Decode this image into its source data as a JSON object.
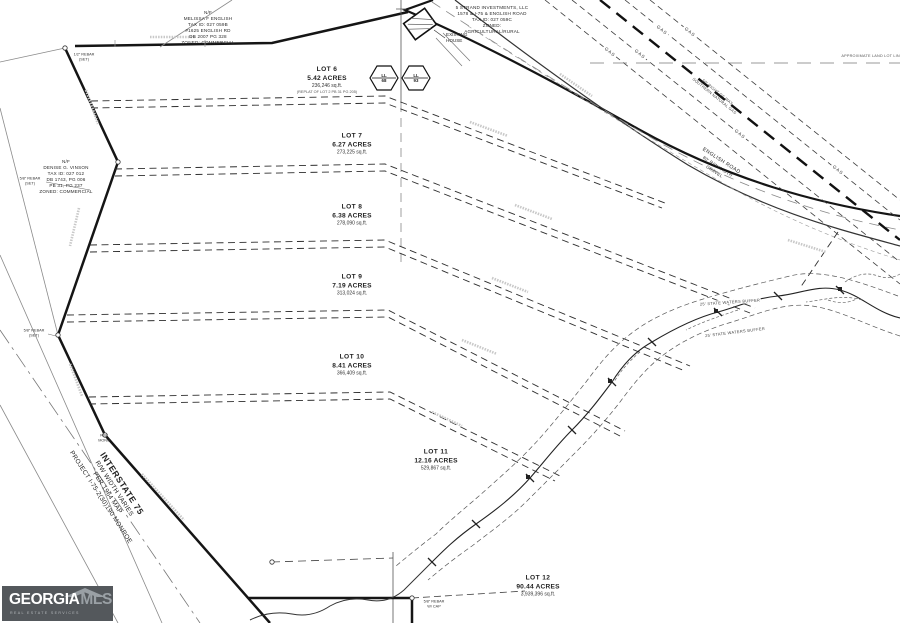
{
  "colors": {
    "line": "#151515",
    "gray": "#8a8a8a",
    "logo_bg": "#54585c"
  },
  "parcels": {
    "melissa": {
      "lines": [
        "N/F",
        "MELISSA F ENGLISH",
        "TAX ID: 027 059B",
        "#1625 ENGLISH RD",
        "DB 2007 PG 328",
        "ZONED: COMMERCIAL"
      ]
    },
    "strand": {
      "lines": [
        "5 STRAND INVESTMENTS, LLC",
        "1578 & I-75 & ENGLISH ROAD",
        "TAX ID: 027 059C",
        "ZONED:",
        "AGRICULTURAL/RURAL"
      ]
    },
    "vinson": {
      "lines": [
        "N/F",
        "DENISE G. VINSON",
        "TAX ID: 027 012",
        "DB 1743, PG 006",
        "PB 31, PG 237",
        "ZONED: COMMERCIAL"
      ]
    }
  },
  "lots": [
    {
      "name": "LOT 6",
      "acres": "5.42 ACRES",
      "sqft": "236,246 sq.ft.",
      "note": "(REPLAT OF LOT 2 PB 31 PG 205)"
    },
    {
      "name": "LOT 7",
      "acres": "6.27 ACRES",
      "sqft": "273,225 sq.ft."
    },
    {
      "name": "LOT 8",
      "acres": "6.38 ACRES",
      "sqft": "278,090 sq.ft."
    },
    {
      "name": "LOT 9",
      "acres": "7.19 ACRES",
      "sqft": "313,024 sq.ft."
    },
    {
      "name": "LOT 10",
      "acres": "8.41 ACRES",
      "sqft": "366,409 sq.ft."
    },
    {
      "name": "LOT 11",
      "acres": "12.16 ACRES",
      "sqft": "529,867 sq.ft."
    },
    {
      "name": "LOT 12",
      "acres": "90.44 ACRES",
      "sqft": "3,939,396 sq.ft."
    }
  ],
  "roads": {
    "interstate": {
      "lines": [
        "INTERSTATE 75",
        "R/W WIDTH VARIES",
        "PER 1964 MAP",
        "PROJECT I-75-2(30)190 MONROE"
      ]
    },
    "english_road": {
      "lines": [
        "ENGLISH ROAD",
        "80' R/W WIDTH",
        "GRAVEL"
      ]
    }
  },
  "utilities": {
    "gas_label": "GAS",
    "sng_rw": {
      "lines": [
        "50' RIGHT OF WAY",
        "SOUTHERN NATURAL GAS"
      ]
    }
  },
  "annotations": {
    "land_lot_line": "APPROXIMATE LAND LOT LINE",
    "waters_buffer": "25' STATE WATERS BUFFER",
    "existing_house": {
      "lines": [
        "EXISTING",
        "HOUSE"
      ]
    },
    "ll_west": {
      "lines": [
        "LL",
        "68"
      ]
    },
    "ll_east": {
      "lines": [
        "LL",
        "93"
      ]
    }
  },
  "markers": [
    {
      "lines": [
        "1/2\" REBAR",
        "(SET)"
      ]
    },
    {
      "lines": [
        "5/8\" REBAR",
        "(SET)"
      ]
    },
    {
      "lines": [
        "5/8\" REBAR",
        "(SET)"
      ]
    },
    {
      "lines": [
        "R/W",
        "MONU"
      ]
    },
    {
      "lines": [
        "5/8\" REBAR",
        "W/ CAP"
      ]
    }
  ],
  "logo": {
    "brand_primary": "GEORGIA",
    "brand_secondary": "MLS",
    "tagline": "REAL ESTATE SERVICES"
  }
}
